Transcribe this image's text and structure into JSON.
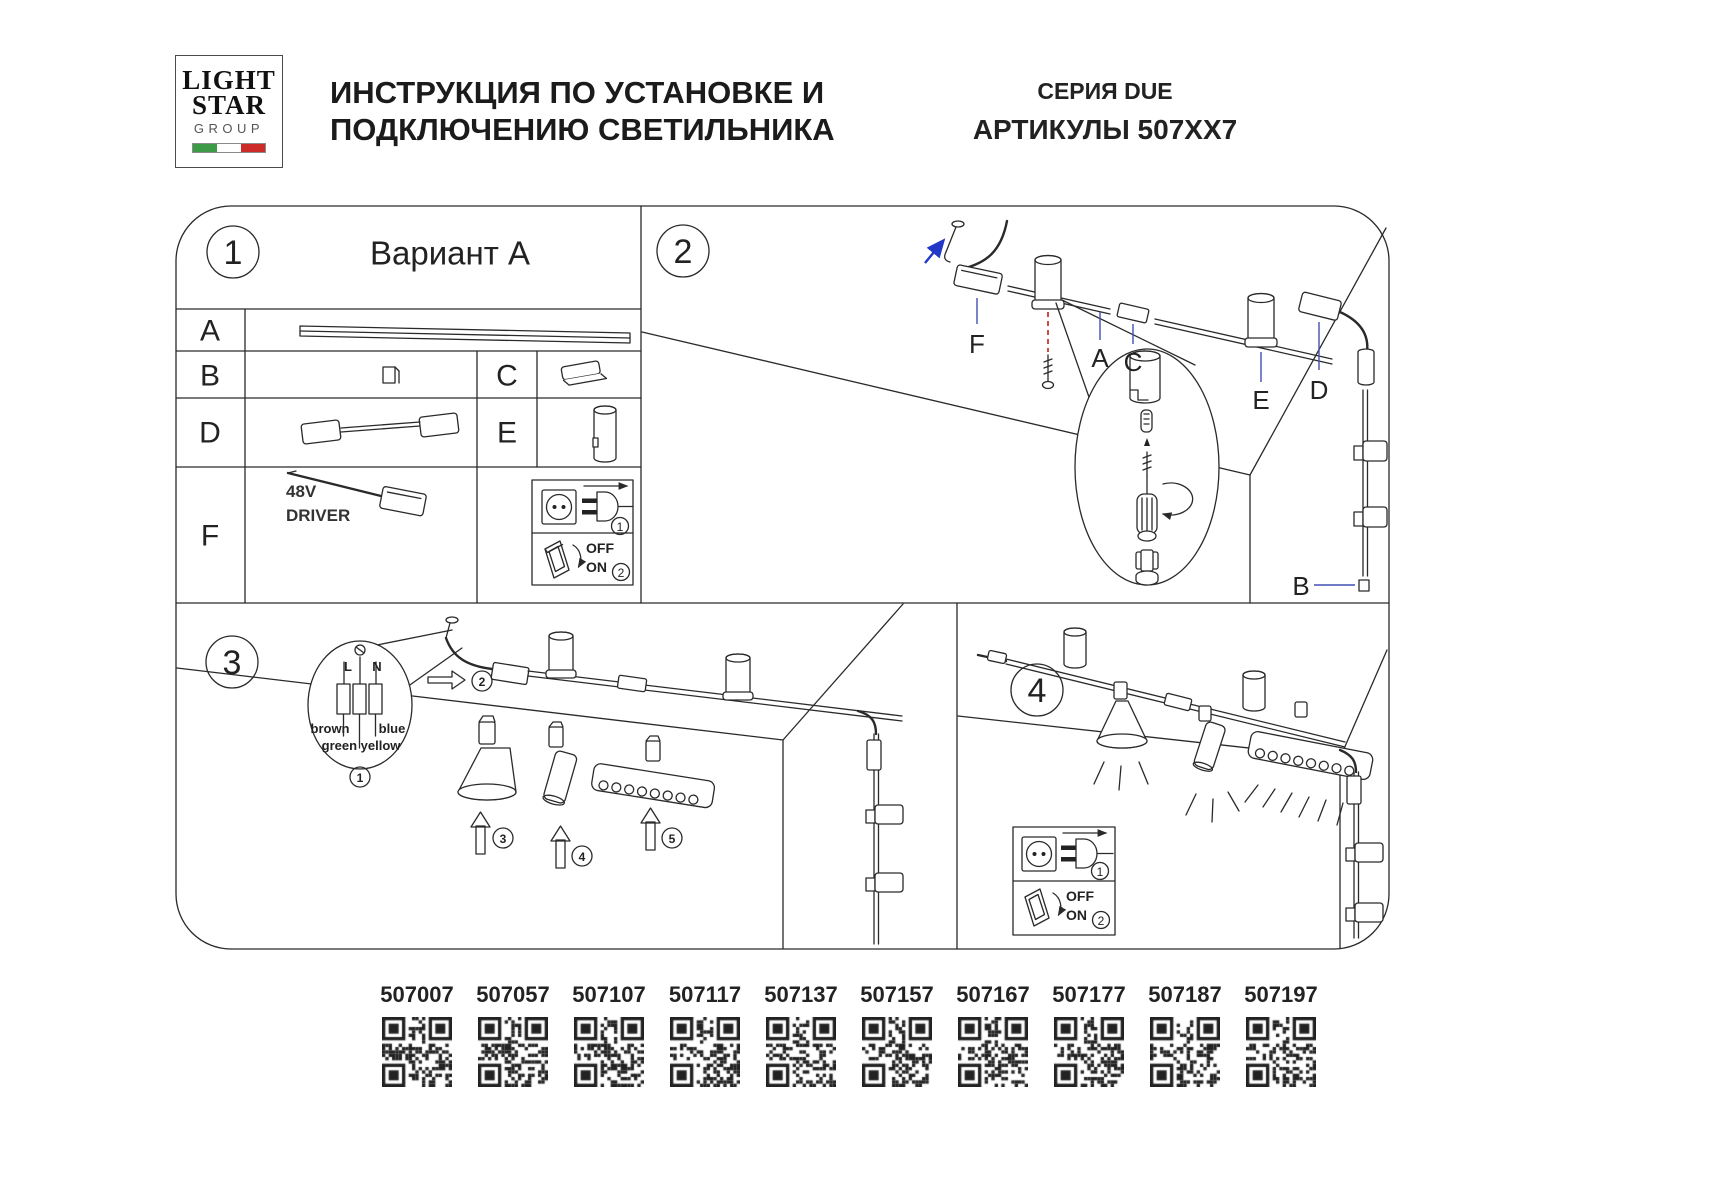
{
  "header": {
    "logo": {
      "line1": "LIGHT",
      "line2": "STAR",
      "line3": "GROUP"
    },
    "title_line1": "ИНСТРУКЦИЯ ПО УСТАНОВКЕ И",
    "title_line2": "ПОДКЛЮЧЕНИЮ СВЕТИЛЬНИКА",
    "series": "СЕРИЯ DUE",
    "articles_label": "АРТИКУЛЫ 507XX7"
  },
  "panel1": {
    "number": "1",
    "title": "Вариант A",
    "rows": {
      "a": "A",
      "b": "B",
      "c": "C",
      "d": "D",
      "e": "E",
      "f": "F"
    },
    "driver_line1": "48V",
    "driver_line2": "DRIVER",
    "plug_step": "1",
    "switch_off": "OFF",
    "switch_on": "ON",
    "switch_step": "2"
  },
  "panel2": {
    "number": "2",
    "labels": {
      "f": "F",
      "a": "A",
      "c": "C",
      "e": "E",
      "d": "D",
      "b": "B"
    }
  },
  "panel3": {
    "number": "3",
    "wiring": {
      "l": "L",
      "n": "N",
      "brown": "brown",
      "blue": "blue",
      "green_yellow": "green yellow",
      "step": "1"
    },
    "steps": {
      "track": "2",
      "cone": "3",
      "spot": "4",
      "linear": "5"
    }
  },
  "panel4": {
    "number": "4",
    "plug_step": "1",
    "switch_off": "OFF",
    "switch_on": "ON",
    "switch_step": "2"
  },
  "colors": {
    "leader_blue": "#4050b5",
    "accent_red": "#c23b2e",
    "arrow_blue": "#2438c8",
    "flag_green": "#3d9b48",
    "flag_red": "#cd2b27"
  },
  "articles": [
    "507007",
    "507057",
    "507107",
    "507117",
    "507137",
    "507157",
    "507167",
    "507177",
    "507187",
    "507197"
  ]
}
